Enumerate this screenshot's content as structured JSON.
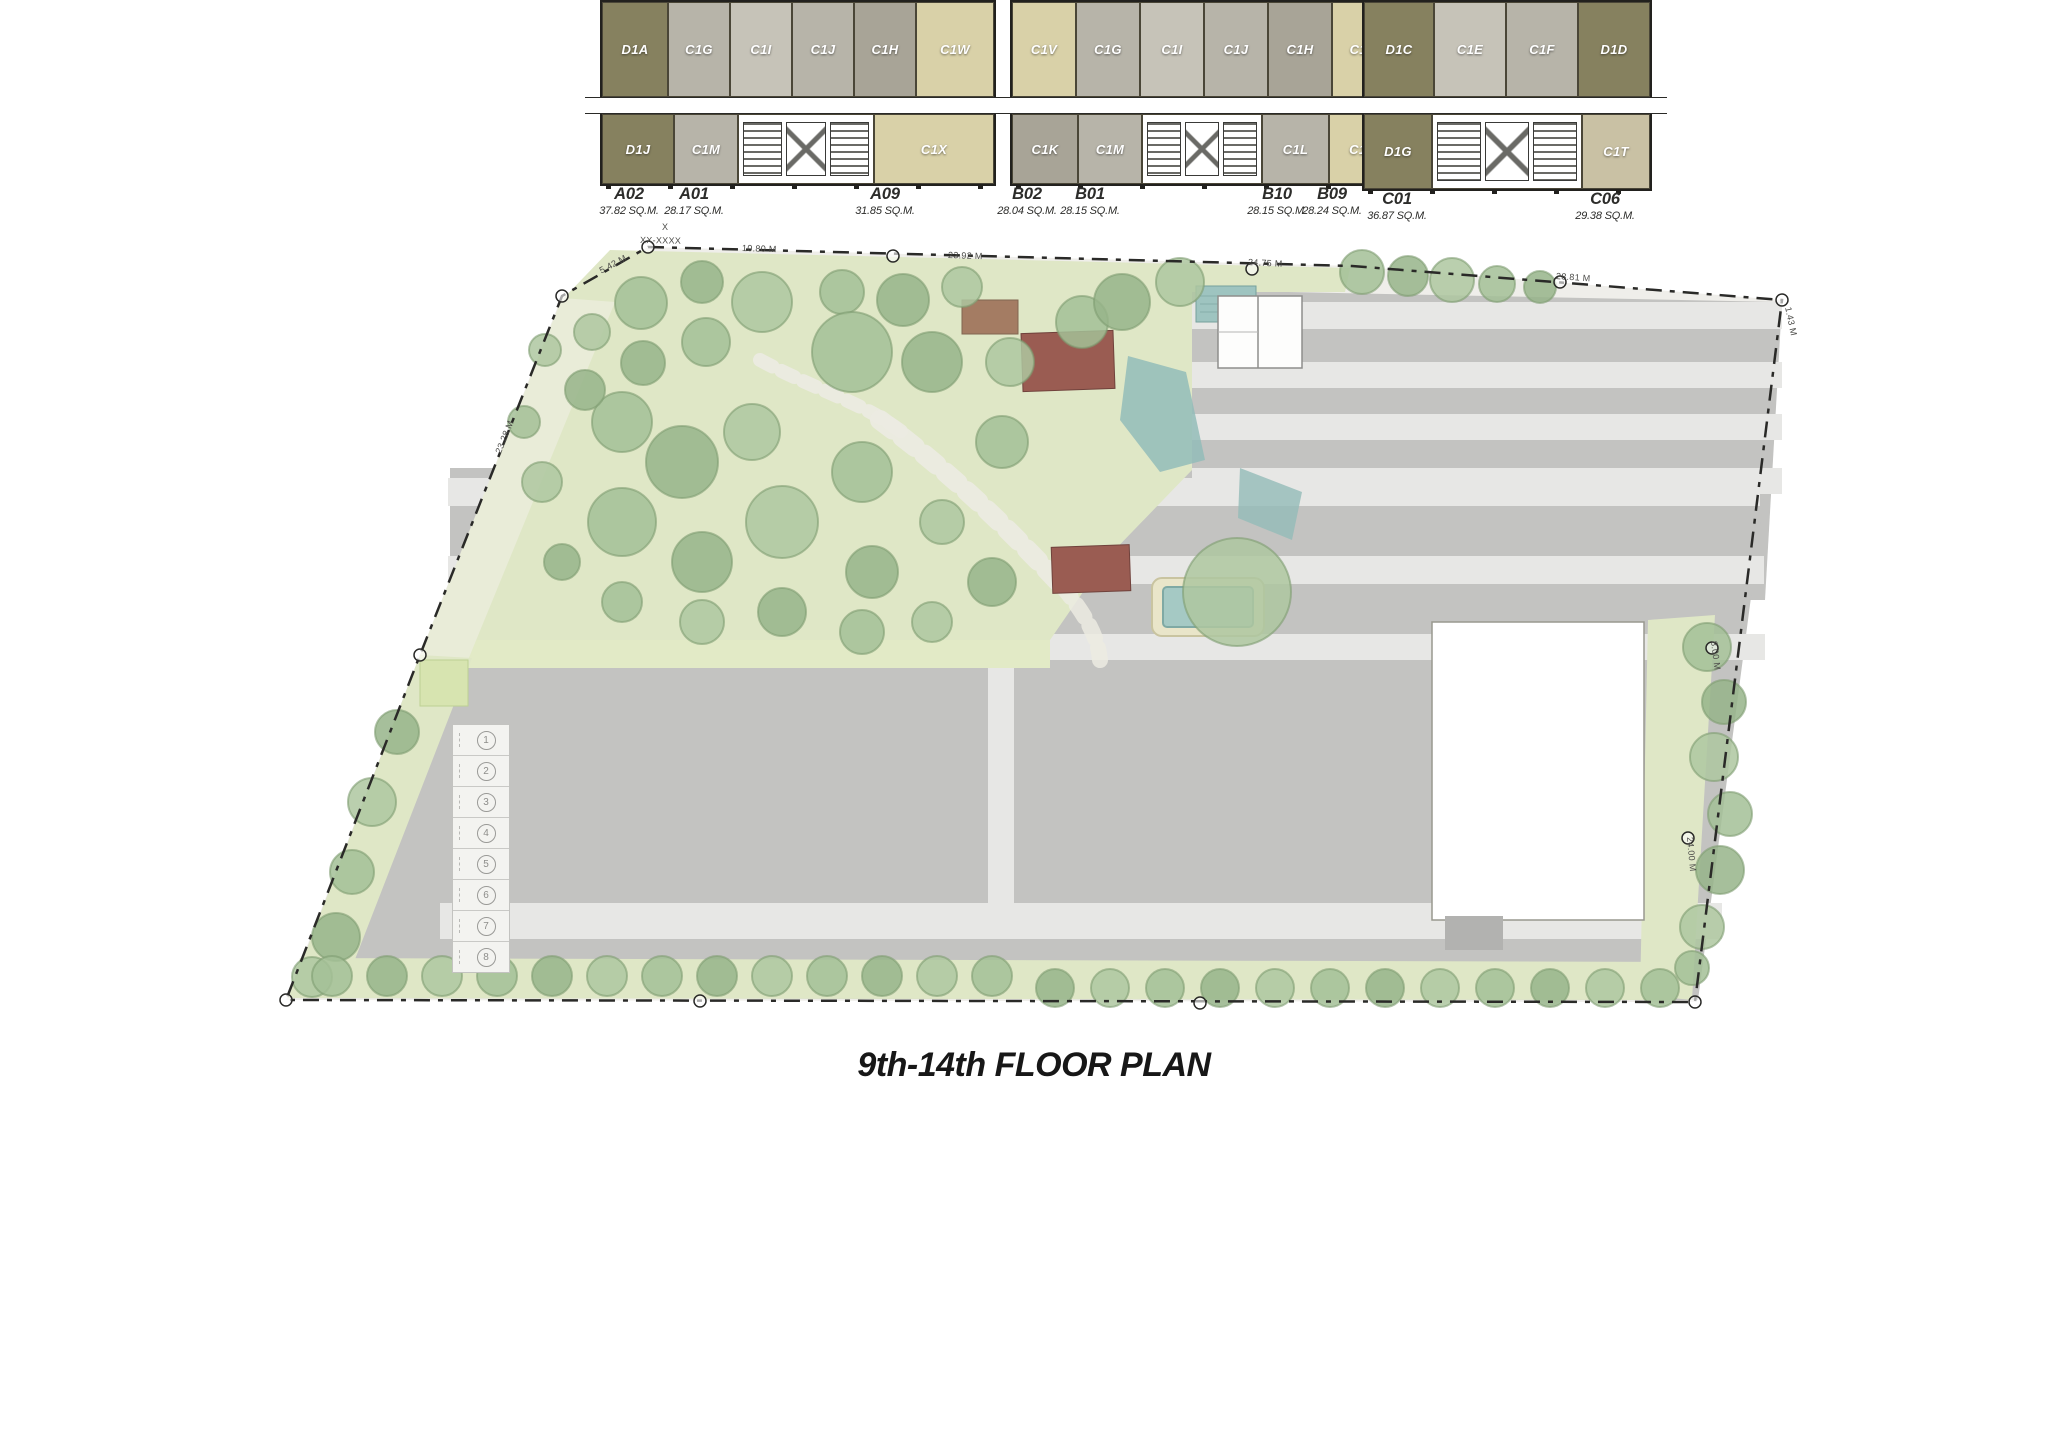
{
  "title": "9th-14th FLOOR PLAN",
  "buildings": {
    "a": {
      "top_units": [
        {
          "id": "A03",
          "area": "35.27 SQ.M."
        },
        {
          "id": "A04",
          "area": "28.70 SQ.M."
        },
        {
          "id": "A05",
          "area": "28.80 SQ.M."
        },
        {
          "id": "A06",
          "area": "28.80 SQ.M."
        },
        {
          "id": "A07",
          "area": "28.68 SQ.M."
        },
        {
          "id": "A08",
          "area": "31.12 SQ.M."
        }
      ],
      "bottom_units": [
        {
          "id": "A02",
          "area": "37.82 SQ.M."
        },
        {
          "id": "A01",
          "area": "28.17 SQ.M."
        },
        {
          "id": "A09",
          "area": "31.85 SQ.M."
        }
      ],
      "top_types": [
        "D1A",
        "C1G",
        "C1I",
        "C1J",
        "C1H",
        "C1W"
      ],
      "bottom_types": [
        "D1J",
        "C1M",
        "C1X"
      ]
    },
    "b": {
      "top_units": [
        {
          "id": "B03",
          "area": "30.03 SQ.M."
        },
        {
          "id": "B04",
          "area": "27.63 SQ.M."
        },
        {
          "id": "B05",
          "area": "27.75 SQ.M."
        },
        {
          "id": "B06",
          "area": "27.75 SQ.M."
        },
        {
          "id": "B07",
          "area": "27.63 SQ.M."
        },
        {
          "id": "B08",
          "area": "29.97 SQ.M."
        }
      ],
      "bottom_units": [
        {
          "id": "B02",
          "area": "28.04 SQ.M."
        },
        {
          "id": "B01",
          "area": "28.15 SQ.M."
        },
        {
          "id": "B10",
          "area": "28.15 SQ.M."
        },
        {
          "id": "B09",
          "area": "28.24 SQ.M."
        }
      ],
      "top_types": [
        "C1V",
        "C1G",
        "C1I",
        "C1J",
        "C1H",
        "C1W"
      ],
      "bottom_types": [
        "C1K",
        "C1M",
        "C1L",
        "C1O"
      ]
    },
    "c": {
      "top_units": [
        {
          "id": "C02",
          "area": "35.92 SQ.M."
        },
        {
          "id": "C03",
          "area": "27.40 SQ.M."
        },
        {
          "id": "C04",
          "area": "27.40 SQ.M."
        },
        {
          "id": "C05",
          "area": "36.02 SQ.M."
        }
      ],
      "bottom_units": [
        {
          "id": "C01",
          "area": "36.87 SQ.M."
        },
        {
          "id": "C06",
          "area": "29.38 SQ.M."
        }
      ],
      "top_types": [
        "D1C",
        "C1E",
        "C1F",
        "D1D"
      ],
      "bottom_types": [
        "D1G",
        "C1T"
      ]
    }
  },
  "parking_stalls": [
    "1",
    "2",
    "3",
    "4",
    "5",
    "6",
    "7",
    "8"
  ],
  "boundary_labels": [
    "X",
    "XX-XXXX",
    "10.80 M",
    "23.92 M",
    "24.75 M",
    "28.81 M",
    "1.43 M",
    "5.42 M",
    "23.28 M",
    "8.00 M",
    "24.00 M"
  ],
  "colors": {
    "unit_olive": "#86815f",
    "unit_gray": "#b7b4a9",
    "unit_gray_light": "#c6c3b8",
    "unit_gray_dark": "#a8a497",
    "unit_tan": "#d9d1a8",
    "unit_tan_muted": "#c9c1a4",
    "corridor_white": "#ffffff",
    "wall_dark": "#22211e",
    "road_gray": "#c3c3c1",
    "lane_light": "#e7e7e5",
    "garden_green": "#dfe7c6",
    "tree_green": "#a3bf97",
    "water_teal": "#93bcb8",
    "pavilion_red": "#9a5c52"
  }
}
